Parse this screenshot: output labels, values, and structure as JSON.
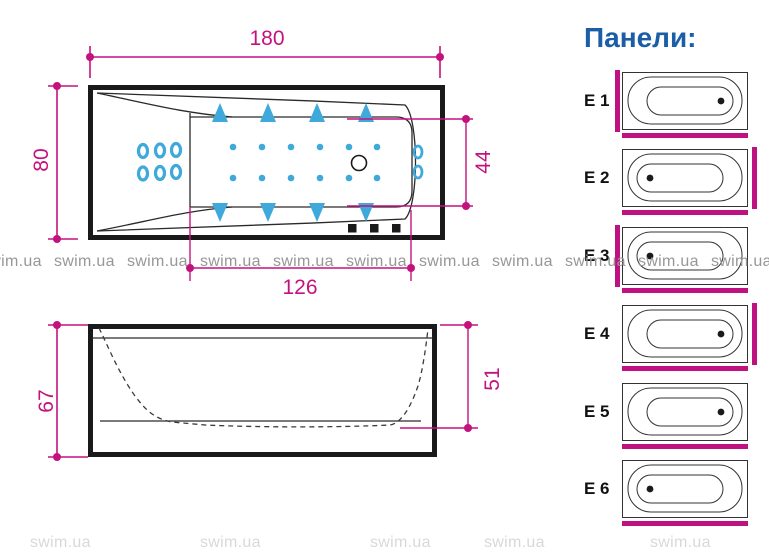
{
  "watermark": {
    "text": "swim.ua"
  },
  "colors": {
    "dimension_magenta": "#c4127d",
    "panel_bar_magenta": "#bf1280",
    "jet_cyan": "#3fa9dc",
    "title_blue": "#1b5ea8",
    "line_black": "#1a1a1a",
    "watermark_gray": "#979797"
  },
  "top_view": {
    "dims": {
      "length": "180",
      "width": "80",
      "inner_width": "44",
      "inner_length": "126"
    },
    "jets": {
      "back_oval_jets": 6,
      "right_oval_jets": 2,
      "top_triangle_jets": 4,
      "bottom_triangle_jets": 4,
      "micro_jets": 12,
      "control_buttons": 3,
      "drain": 1
    }
  },
  "side_view": {
    "dims": {
      "height": "67",
      "inner_depth": "51"
    }
  },
  "panels": {
    "title": "Панели:",
    "items": [
      {
        "label": "E 1",
        "side_panel": "left",
        "front_panel": true,
        "drain": "right"
      },
      {
        "label": "E 2",
        "side_panel": "right",
        "front_panel": true,
        "drain": "left"
      },
      {
        "label": "E 3",
        "side_panel": "left",
        "front_panel": true,
        "drain": "left"
      },
      {
        "label": "E 4",
        "side_panel": "right",
        "front_panel": true,
        "drain": "right"
      },
      {
        "label": "E 5",
        "side_panel": "none",
        "front_panel": true,
        "drain": "right"
      },
      {
        "label": "E 6",
        "side_panel": "none",
        "front_panel": true,
        "drain": "left"
      }
    ]
  }
}
